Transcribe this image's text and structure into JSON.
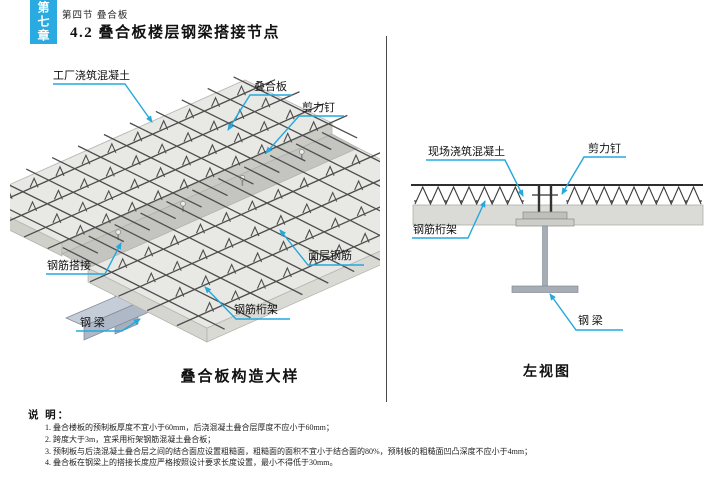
{
  "page": {
    "chapter_tab": "第七章",
    "section_label": "第四节 叠合板",
    "title": "4.2 叠合板楼层钢梁搭接节点"
  },
  "figures": {
    "left": {
      "caption": "叠合板构造大样",
      "labels": {
        "factory_concrete": "工厂浇筑混凝土",
        "composite_slab": "叠合板",
        "shear_stud": "剪力钉",
        "rebar_lap": "钢筋搭接",
        "steel_beam": "钢 梁",
        "surface_rebar": "面层钢筋",
        "rebar_truss": "钢筋桁架"
      }
    },
    "right": {
      "caption": "左视图",
      "labels": {
        "site_concrete": "现场浇筑混凝土",
        "shear_stud": "剪力钉",
        "rebar_truss": "钢筋桁架",
        "steel_beam": "钢 梁"
      }
    }
  },
  "notes": {
    "heading": "说 明：",
    "items": [
      "1. 叠合楼板的预制板厚度不宜小于60mm，后浇混凝土叠合层厚度不应小于60mm；",
      "2. 跨度大于3m，宜采用桁架钢筋混凝土叠合板；",
      "3. 预制板与后浇混凝土叠合层之间的结合面应设置粗糙面，粗糙面的面积不宜小于结合面的80%，预制板的粗糙面凹凸深度不应小于4mm；",
      "4. 叠合板在钢梁上的搭接长度应严格按照设计要求长度设置，最小不得低于30mm。"
    ]
  },
  "colors": {
    "accent": "#29abe2",
    "leader": "#25a8dd",
    "beam": "#aeb8c6",
    "slab": "#e8e8e4"
  }
}
